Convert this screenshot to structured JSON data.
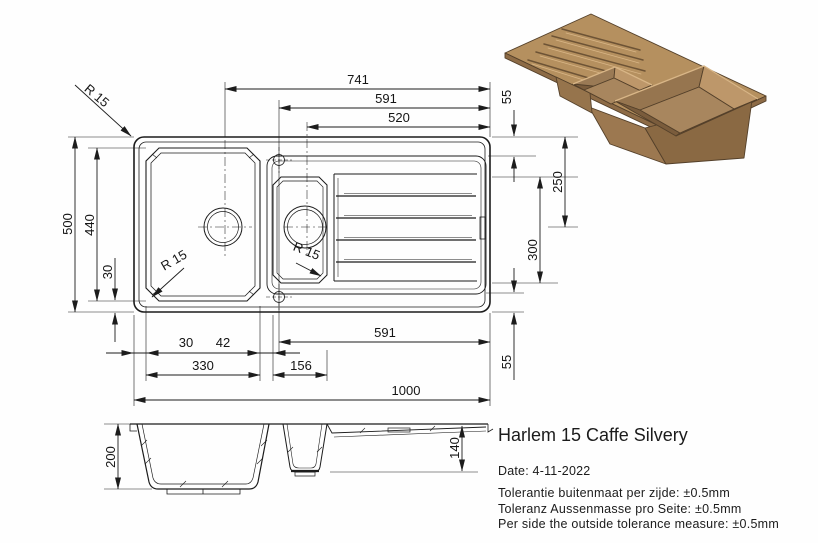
{
  "product": {
    "title": "Harlem 15 Caffe Silvery",
    "date": "Date: 4-11-2022",
    "tolerances": [
      "Tolerantie buitenmaat per zijde: ±0.5mm",
      "Toleranz Aussenmasse pro Seite: ±0.5mm",
      "Per side the outside tolerance measure: ±0.5mm"
    ]
  },
  "dims": {
    "top_741": "741",
    "top_591": "591",
    "top_520": "520",
    "right_55_top": "55",
    "right_250": "250",
    "right_300": "300",
    "right_55_bottom": "55",
    "left_500": "500",
    "left_440": "440",
    "left_30": "30",
    "bottom_30": "30",
    "bottom_42": "42",
    "bottom_330": "330",
    "bottom_156": "156",
    "bottom_591": "591",
    "bottom_1000": "1000",
    "section_200": "200",
    "section_140": "140",
    "radius_top_left": "R 15",
    "radius_main_basin": "R 15",
    "radius_small_basin": "R 15"
  },
  "colors": {
    "line": "#1c1c1c",
    "render": {
      "top": "#b5905f",
      "edge": "#8d6b46",
      "face_front": "#9c7850",
      "face_side": "#8a6943",
      "wall_mid": "#96754f",
      "wall_light": "#bd976a",
      "wall_left": "#9a7a55",
      "floor": "#a8865e",
      "front_left": "#7a5c3c",
      "front_right": "#6f5336",
      "groove": "#6d5335",
      "rim_highlight": "#d9b687",
      "step": "#96744c"
    }
  }
}
